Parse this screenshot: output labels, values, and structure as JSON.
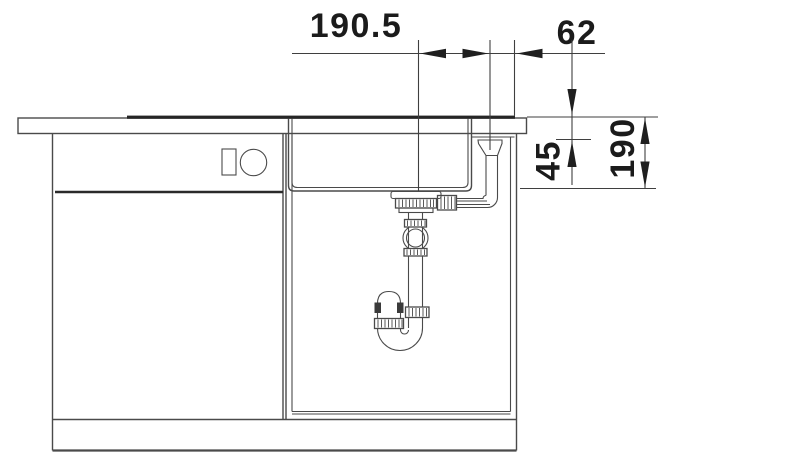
{
  "drawing": {
    "labels": {
      "dim_drain_to_overflow": "190.5",
      "dim_overflow_to_edge": "62",
      "dim_overflow_depth": "45",
      "dim_bowl_depth": "190"
    },
    "colors": {
      "line": "#4a4a4a",
      "dark_accent": "#262626",
      "dimension_text": "#1b1b1b",
      "background": "#ffffff"
    }
  }
}
